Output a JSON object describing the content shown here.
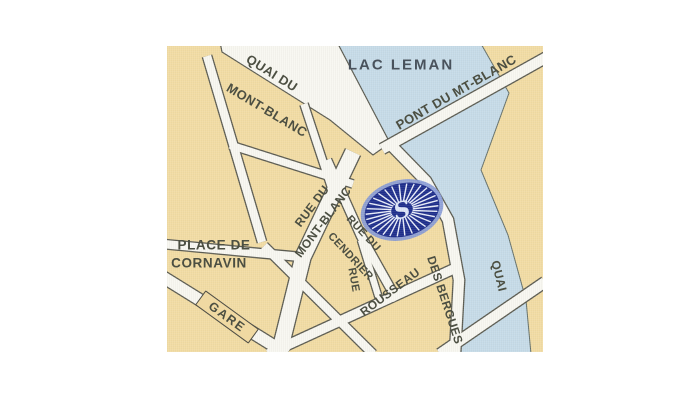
{
  "map": {
    "labels": {
      "lac_leman": "LAC LEMAN",
      "quai_du_mont_blanc_line1": "QUAI DU",
      "quai_du_mont_blanc_line2": "MONT-BLANC",
      "pont_du_mt_blanc": "PONT DU MT-BLANC",
      "rue_du_mont_blanc_line1": "RUE DU",
      "rue_du_mont_blanc_line2": "MONT-BLANC",
      "rue_du_cendrier_line1": "RUE DU",
      "rue_du_cendrier_line2": "CENDRIER",
      "rue_rousseau_line1": "RUE",
      "rue_rousseau_line2": "ROUSSEAU",
      "quai_des_bergues_line1": "QUAI",
      "quai_des_bergues_line2": "DES BERGUES",
      "place_de_cornavin_line1": "PLACE DE",
      "place_de_cornavin_line2": "CORNAVIN",
      "gare": "GARE",
      "logo_letter": "S"
    },
    "icons": {
      "hotel_logo": "sunburst-rosette-logo"
    },
    "colors": {
      "land": "#f2dca4",
      "water": "#c6dbe8",
      "water_edge": "#64706b",
      "road": "#f8f7f1",
      "casing": "#5b5b51",
      "label": "#4c4f42",
      "water_label": "#49525c",
      "logo_navy": "#1e2e8c",
      "logo_fringe": "#8498d6",
      "logo_ray": "#e9eefb",
      "logo_letter": "#dde6f8",
      "gare_fill": "#f0d9a2"
    }
  }
}
